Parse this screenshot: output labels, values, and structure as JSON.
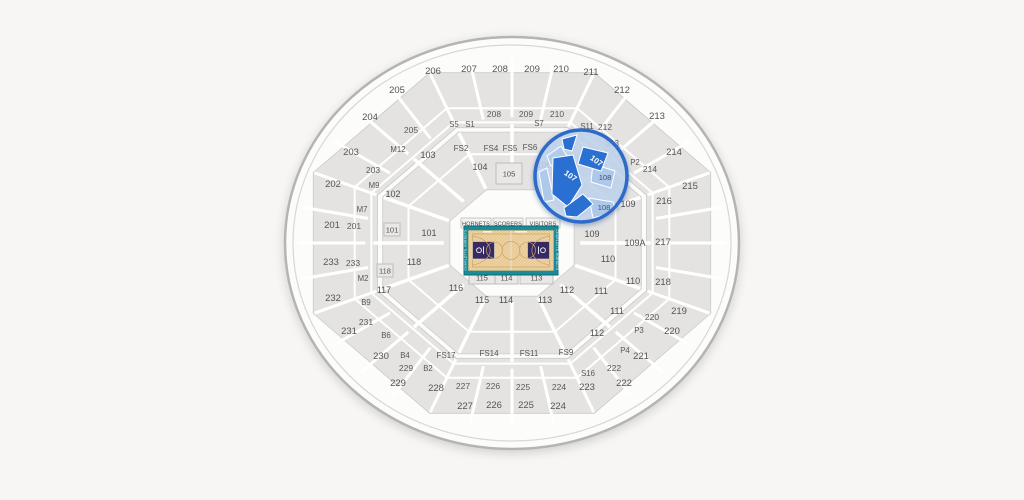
{
  "page": {
    "background": "#f7f6f4",
    "title": "Arena seating map"
  },
  "colors": {
    "arena_fill": "#fcfcfb",
    "arena_ring": "#b5b4b3",
    "arena_ring_inner": "#d8d7d6",
    "band_fill": "#e4e3e2",
    "band_stroke": "#cbcac9",
    "aisle": "#ffffff",
    "court_border": "#1b8a99",
    "court_floor": "#eed2a0",
    "court_key": "#372a63",
    "court_line": "#c8a468",
    "magnifier_border": "#2e6bc8",
    "magnifier_tint": "#c3d8f0",
    "magnifier_highlight": "#2a6fd2",
    "magnifier_muted": "#aac7e9"
  },
  "court": {
    "bench_labels": [
      "HORNETS",
      "SCORERS",
      "VISITORS"
    ],
    "side_text_left": "CHARLOTTE HORNETS",
    "side_text_right": "CHARLOTTE HORNETS"
  },
  "magnifier": {
    "selected_section": "107",
    "labels_107": [
      "107",
      "107"
    ],
    "labels_108": [
      "108",
      "108"
    ]
  },
  "sections": {
    "level200": [
      {
        "label": "206",
        "x": 433,
        "y": 71
      },
      {
        "label": "207",
        "x": 469,
        "y": 69
      },
      {
        "label": "208",
        "x": 500,
        "y": 69
      },
      {
        "label": "209",
        "x": 532,
        "y": 69
      },
      {
        "label": "210",
        "x": 561,
        "y": 69
      },
      {
        "label": "211",
        "x": 591,
        "y": 72
      },
      {
        "label": "205",
        "x": 397,
        "y": 90
      },
      {
        "label": "212",
        "x": 622,
        "y": 90
      },
      {
        "label": "204",
        "x": 370,
        "y": 117
      },
      {
        "label": "213",
        "x": 657,
        "y": 116
      },
      {
        "label": "203",
        "x": 351,
        "y": 152
      },
      {
        "label": "214",
        "x": 674,
        "y": 152
      },
      {
        "label": "202",
        "x": 333,
        "y": 184
      },
      {
        "label": "215",
        "x": 690,
        "y": 186
      },
      {
        "label": "216",
        "x": 664,
        "y": 201
      },
      {
        "label": "201",
        "x": 332,
        "y": 225
      },
      {
        "label": "217",
        "x": 663,
        "y": 242
      },
      {
        "label": "233",
        "x": 331,
        "y": 262
      },
      {
        "label": "218",
        "x": 663,
        "y": 282
      },
      {
        "label": "232",
        "x": 333,
        "y": 298
      },
      {
        "label": "219",
        "x": 679,
        "y": 311
      },
      {
        "label": "231",
        "x": 349,
        "y": 331
      },
      {
        "label": "220",
        "x": 672,
        "y": 331
      },
      {
        "label": "230",
        "x": 381,
        "y": 356
      },
      {
        "label": "221",
        "x": 641,
        "y": 356
      },
      {
        "label": "229",
        "x": 398,
        "y": 383
      },
      {
        "label": "222",
        "x": 624,
        "y": 383
      },
      {
        "label": "228",
        "x": 436,
        "y": 388
      },
      {
        "label": "223",
        "x": 587,
        "y": 387
      },
      {
        "label": "227",
        "x": 465,
        "y": 406
      },
      {
        "label": "226",
        "x": 494,
        "y": 405
      },
      {
        "label": "225",
        "x": 526,
        "y": 405
      },
      {
        "label": "224",
        "x": 558,
        "y": 406
      }
    ],
    "level200_inner": [
      {
        "label": "208",
        "x": 494,
        "y": 114
      },
      {
        "label": "209",
        "x": 526,
        "y": 114
      },
      {
        "label": "210",
        "x": 557,
        "y": 114
      },
      {
        "label": "205",
        "x": 411,
        "y": 130
      },
      {
        "label": "212",
        "x": 605,
        "y": 127
      },
      {
        "label": "203",
        "x": 373,
        "y": 170
      },
      {
        "label": "214",
        "x": 650,
        "y": 169
      },
      {
        "label": "201",
        "x": 354,
        "y": 226
      },
      {
        "label": "233",
        "x": 353,
        "y": 263
      },
      {
        "label": "231",
        "x": 366,
        "y": 322
      },
      {
        "label": "220",
        "x": 652,
        "y": 317
      },
      {
        "label": "229",
        "x": 406,
        "y": 368
      },
      {
        "label": "222",
        "x": 614,
        "y": 368
      },
      {
        "label": "227",
        "x": 463,
        "y": 386
      },
      {
        "label": "226",
        "x": 493,
        "y": 386
      },
      {
        "label": "225",
        "x": 523,
        "y": 387
      },
      {
        "label": "224",
        "x": 559,
        "y": 387
      }
    ],
    "suites": [
      {
        "label": "S5",
        "x": 454,
        "y": 124
      },
      {
        "label": "S1",
        "x": 470,
        "y": 124
      },
      {
        "label": "S7",
        "x": 539,
        "y": 123
      },
      {
        "label": "S11",
        "x": 587,
        "y": 126
      },
      {
        "label": "S13",
        "x": 612,
        "y": 143
      },
      {
        "label": "S16",
        "x": 588,
        "y": 373
      },
      {
        "label": "M12",
        "x": 398,
        "y": 149
      },
      {
        "label": "M9",
        "x": 374,
        "y": 185
      },
      {
        "label": "M7",
        "x": 362,
        "y": 209
      },
      {
        "label": "M2",
        "x": 363,
        "y": 278
      },
      {
        "label": "B9",
        "x": 366,
        "y": 302
      },
      {
        "label": "B6",
        "x": 386,
        "y": 335
      },
      {
        "label": "B4",
        "x": 405,
        "y": 355
      },
      {
        "label": "B2",
        "x": 428,
        "y": 368
      },
      {
        "label": "P2",
        "x": 635,
        "y": 162
      },
      {
        "label": "P3",
        "x": 639,
        "y": 330
      },
      {
        "label": "P4",
        "x": 625,
        "y": 350
      }
    ],
    "floor_suites": [
      {
        "label": "FS2",
        "x": 461,
        "y": 148
      },
      {
        "label": "FS4",
        "x": 491,
        "y": 148
      },
      {
        "label": "FS5",
        "x": 510,
        "y": 148
      },
      {
        "label": "FS6",
        "x": 530,
        "y": 147
      },
      {
        "label": "FS8",
        "x": 566,
        "y": 148
      },
      {
        "label": "FS17",
        "x": 446,
        "y": 355
      },
      {
        "label": "FS14",
        "x": 489,
        "y": 353
      },
      {
        "label": "FS11",
        "x": 529,
        "y": 353
      },
      {
        "label": "FS9",
        "x": 566,
        "y": 352
      }
    ],
    "level100": [
      {
        "label": "103",
        "x": 428,
        "y": 155
      },
      {
        "label": "104",
        "x": 480,
        "y": 167
      },
      {
        "label": "106",
        "x": 544,
        "y": 165
      },
      {
        "label": "102",
        "x": 393,
        "y": 194
      },
      {
        "label": "101",
        "x": 429,
        "y": 233
      },
      {
        "label": "109",
        "x": 628,
        "y": 204
      },
      {
        "label": "109",
        "x": 592,
        "y": 234
      },
      {
        "label": "109A",
        "x": 635,
        "y": 243
      },
      {
        "label": "110",
        "x": 608,
        "y": 259
      },
      {
        "label": "118",
        "x": 414,
        "y": 262
      },
      {
        "label": "110",
        "x": 633,
        "y": 281
      },
      {
        "label": "117",
        "x": 384,
        "y": 290
      },
      {
        "label": "116",
        "x": 456,
        "y": 288
      },
      {
        "label": "112",
        "x": 567,
        "y": 290
      },
      {
        "label": "111",
        "x": 601,
        "y": 291
      },
      {
        "label": "111",
        "x": 617,
        "y": 311
      },
      {
        "label": "112",
        "x": 597,
        "y": 333
      },
      {
        "label": "115",
        "x": 482,
        "y": 300
      },
      {
        "label": "114",
        "x": 506,
        "y": 300
      },
      {
        "label": "113",
        "x": 545,
        "y": 300
      }
    ],
    "floor_boxes": [
      {
        "label": "101",
        "box": [
          384,
          223,
          16,
          13
        ]
      },
      {
        "label": "118",
        "box": [
          377,
          264,
          16,
          13
        ]
      },
      {
        "label": "105",
        "box": [
          496,
          163,
          26,
          21
        ]
      },
      {
        "label": "115",
        "box": [
          469,
          271,
          26,
          13
        ]
      },
      {
        "label": "114",
        "box": [
          495,
          271,
          23,
          13
        ]
      },
      {
        "label": "113",
        "box": [
          520,
          271,
          33,
          13
        ]
      }
    ]
  }
}
